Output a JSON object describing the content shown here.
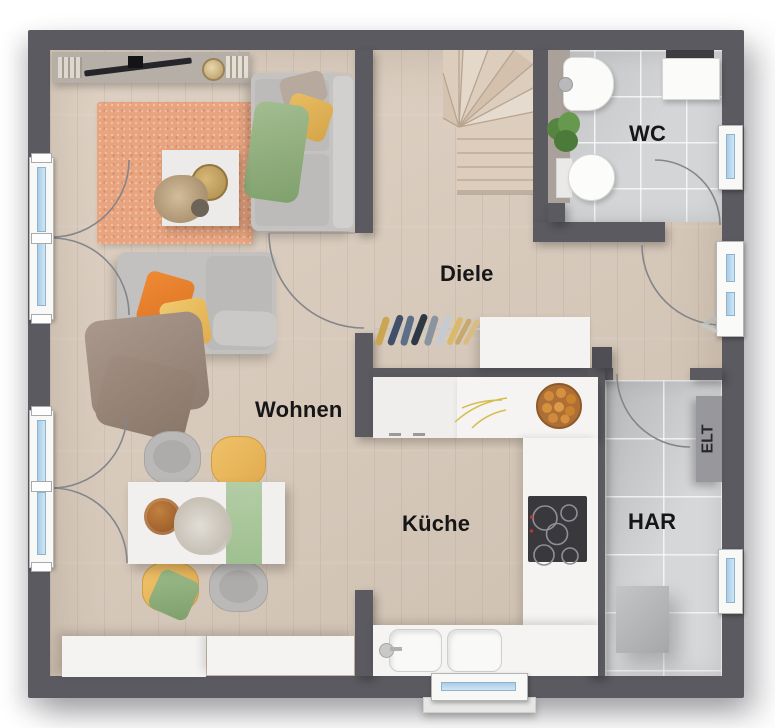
{
  "rooms": [
    {
      "id": "wohnen",
      "label": "Wohnen"
    },
    {
      "id": "diele",
      "label": "Diele"
    },
    {
      "id": "wc",
      "label": "WC"
    },
    {
      "id": "kueche",
      "label": "Küche"
    },
    {
      "id": "har",
      "label": "HAR"
    },
    {
      "id": "elt",
      "label": "ELT"
    }
  ],
  "colors": {
    "wall": "#5a5a60",
    "wood_floor": "#dacbbb",
    "tile_floor": "#d4d5d7",
    "rug": "#e8a47f",
    "window_glass": "#b5d4ea",
    "label_text": "#161616",
    "chair_yellow": "#edba60",
    "runner_green": "#aac79d",
    "pillow_orange": "#e8812e",
    "pillow_yellow": "#eec467",
    "blanket_green": "#96b585",
    "cabinet_white": "#f4f3f1",
    "stairs_wood": "#dccdbc",
    "cooktop": "#38383d"
  }
}
